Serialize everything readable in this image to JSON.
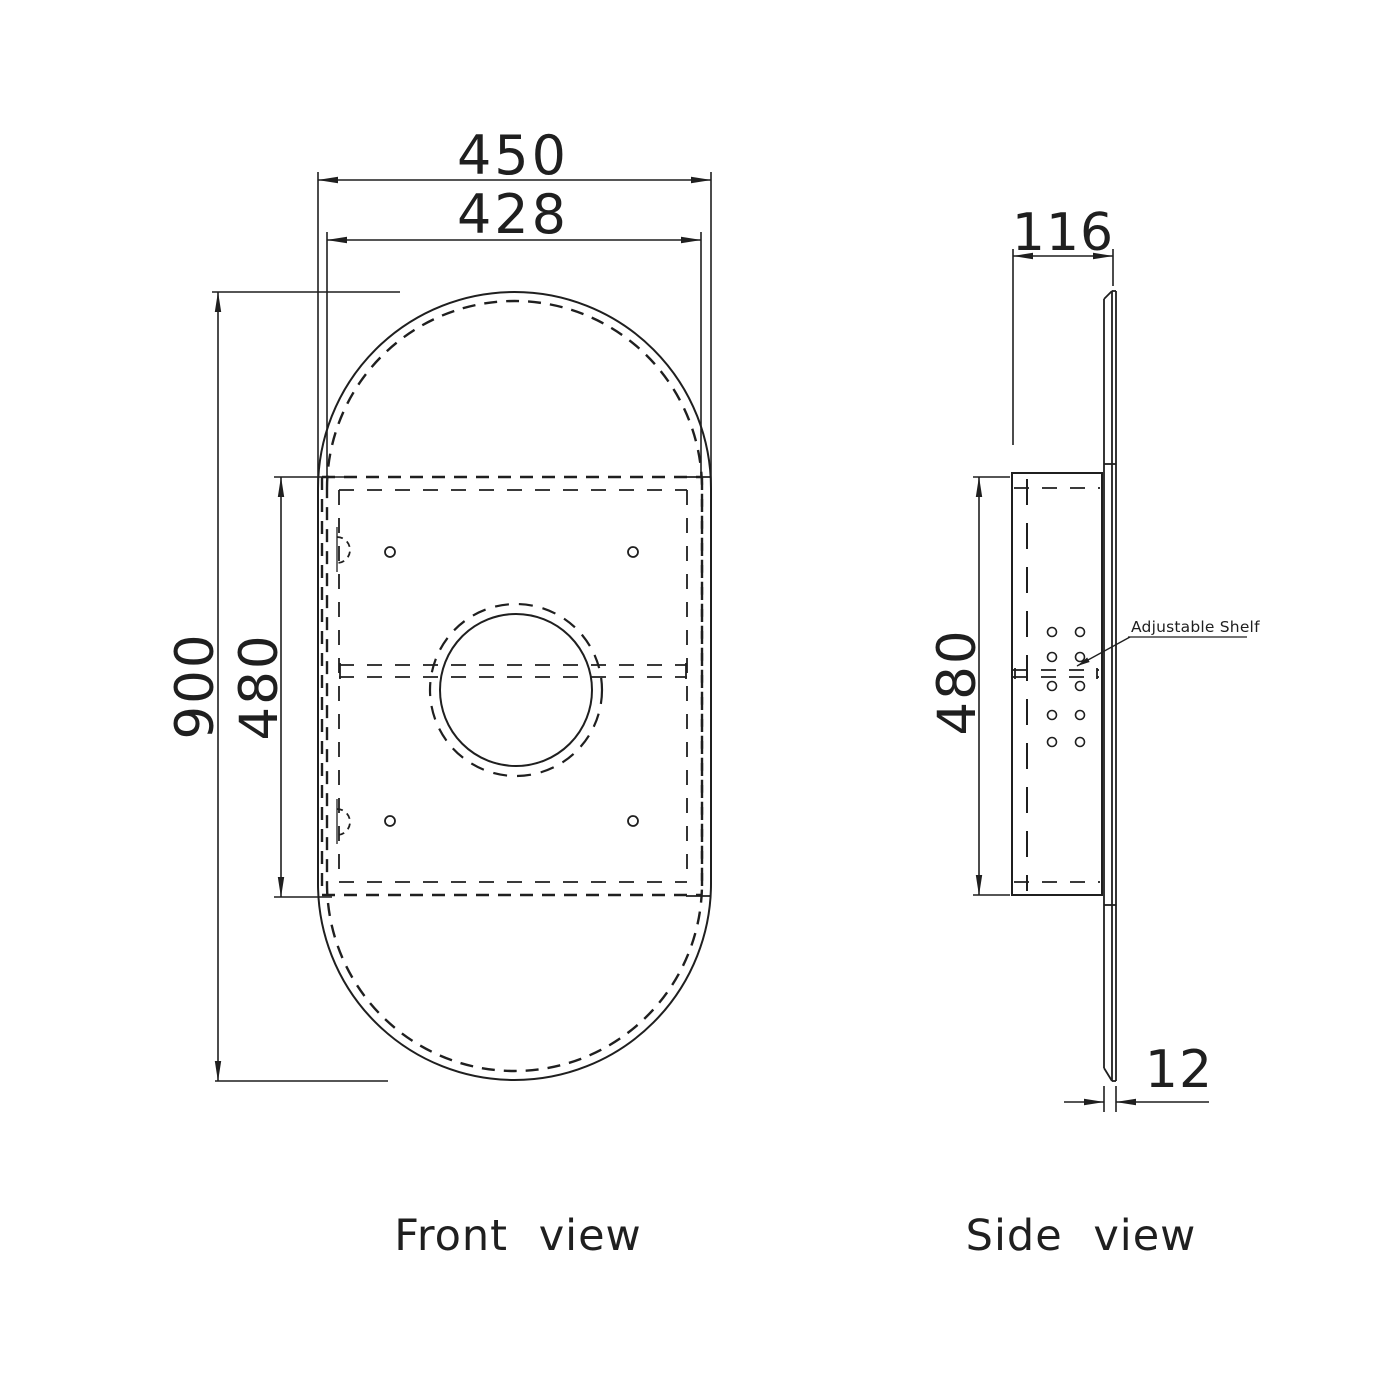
{
  "drawing": {
    "front_view": {
      "label": "Front view",
      "dim_width_outer": "450",
      "dim_width_inner": "428",
      "dim_height": "900",
      "dim_cabinet_height": "480"
    },
    "side_view": {
      "label": "Side view",
      "dim_depth": "116",
      "dim_cabinet_height": "480",
      "dim_door_thickness": "12",
      "shelf_note": "Adjustable Shelf"
    },
    "colors": {
      "line": "#1f1f1f",
      "background": "#ffffff"
    }
  }
}
